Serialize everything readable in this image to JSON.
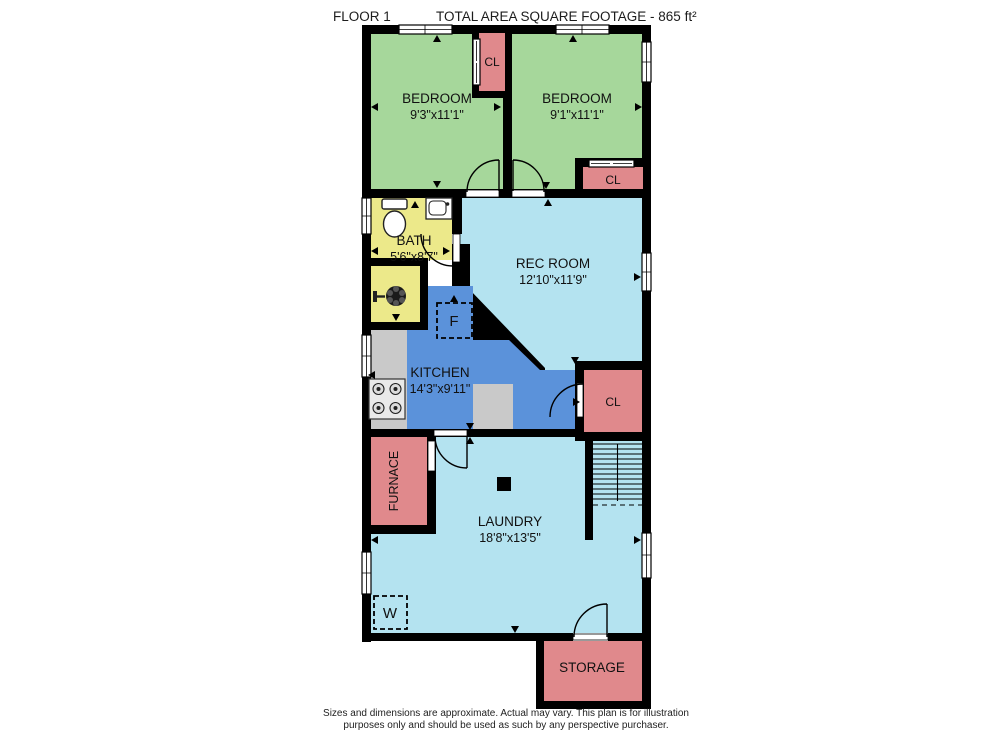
{
  "header": {
    "floor_label": "FLOOR 1",
    "total_area_label": "TOTAL AREA SQUARE FOOTAGE - 865 ft²"
  },
  "rooms": {
    "bedroom_left": {
      "name": "BEDROOM",
      "dims": "9'3\"x11'1\""
    },
    "bedroom_right": {
      "name": "BEDROOM",
      "dims": "9'1\"x11'1\""
    },
    "closet_between_bedrooms": {
      "name": "CL"
    },
    "closet_bedroom_right": {
      "name": "CL"
    },
    "bath": {
      "name": "BATH",
      "dims": "5'6\"x8'7\""
    },
    "rec_room": {
      "name": "REC ROOM",
      "dims": "12'10\"x11'9\""
    },
    "kitchen": {
      "name": "KITCHEN",
      "dims": "14'3\"x9'11\""
    },
    "closet_kitchen": {
      "name": "CL"
    },
    "furnace": {
      "name": "FURNACE"
    },
    "laundry": {
      "name": "LAUNDRY",
      "dims": "18'8\"x13'5\""
    },
    "storage": {
      "name": "STORAGE"
    }
  },
  "appliances": {
    "refrigerator_label": "F",
    "washer_label": "W"
  },
  "footer": {
    "line1": "Sizes and dimensions are approximate. Actual may vary. This plan is for illustration",
    "line2": "purposes only and should be used as such by any perspective purchaser."
  },
  "colors": {
    "bedroom_green": "#a6d79b",
    "closet_pink": "#e0898c",
    "bath_yellow": "#ece98a",
    "living_light_blue": "#b4e3f0",
    "kitchen_blue": "#5b92da",
    "counter_gray": "#c9c9c9",
    "wall_black": "#000000"
  }
}
